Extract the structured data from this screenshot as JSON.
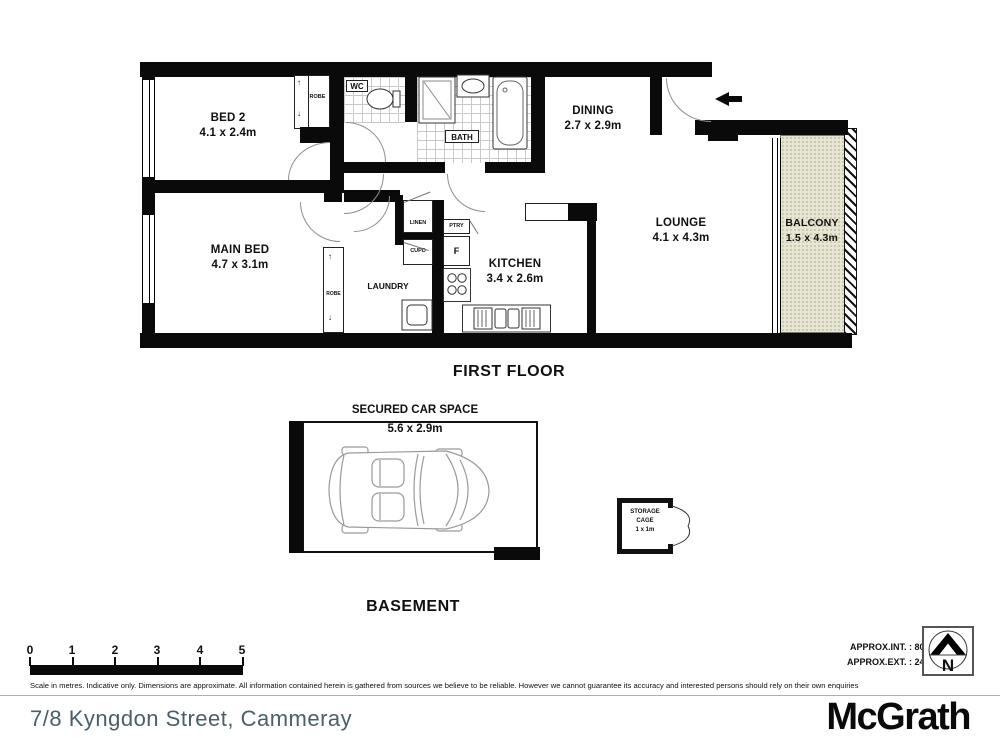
{
  "plan": {
    "first_floor_title": "FIRST FLOOR",
    "basement_title": "BASEMENT",
    "rooms": {
      "bed2": {
        "name": "BED 2",
        "dims": "4.1 x 2.4m"
      },
      "main_bed": {
        "name": "MAIN BED",
        "dims": "4.7 x 3.1m"
      },
      "dining": {
        "name": "DINING",
        "dims": "2.7 x 2.9m"
      },
      "lounge": {
        "name": "LOUNGE",
        "dims": "4.1 x 4.3m"
      },
      "balcony": {
        "name": "BALCONY",
        "dims": "1.5 x 4.3m"
      },
      "kitchen": {
        "name": "KITCHEN",
        "dims": "3.4 x 2.6m"
      },
      "laundry": {
        "name": "LAUNDRY"
      },
      "bath": {
        "name": "BATH"
      },
      "wc": {
        "name": "WC"
      },
      "robe_bed2": {
        "name": "ROBE"
      },
      "robe_main": {
        "name": "ROBE"
      },
      "linen": {
        "name": "LINEN"
      },
      "cupd": {
        "name": "CUPD"
      },
      "pantry": {
        "name": "PTRY"
      },
      "fridge": {
        "name": "F"
      }
    }
  },
  "basement": {
    "car_space_name": "SECURED CAR SPACE",
    "car_space_dims": "5.6 x 2.9m",
    "storage_cage": [
      "STORAGE",
      "CAGE",
      "1 x 1m"
    ]
  },
  "scale_bar": {
    "ticks": [
      "0",
      "1",
      "2",
      "3",
      "4",
      "5"
    ]
  },
  "areas": {
    "internal": "APPROX.INT. : 80 m²",
    "external": "APPROX.EXT. : 24 m²"
  },
  "compass": {
    "label": "N"
  },
  "disclaimer": "Scale in metres. Indicative only. Dimensions are approximate. All information contained herein is gathered from sources we believe to be reliable. However we cannot guarantee its accuracy and interested persons should rely on their own enquiries",
  "footer": {
    "address": "7/8 Kyngdon Street, Cammeray",
    "brand": "McGrath"
  },
  "icons": {
    "slide_arrow_up": "↑",
    "slide_arrow_down": "↓"
  },
  "colors": {
    "wall": "#0a0a0a",
    "balcony_fill": "#e7e5d3",
    "address_text": "#4a6069"
  }
}
